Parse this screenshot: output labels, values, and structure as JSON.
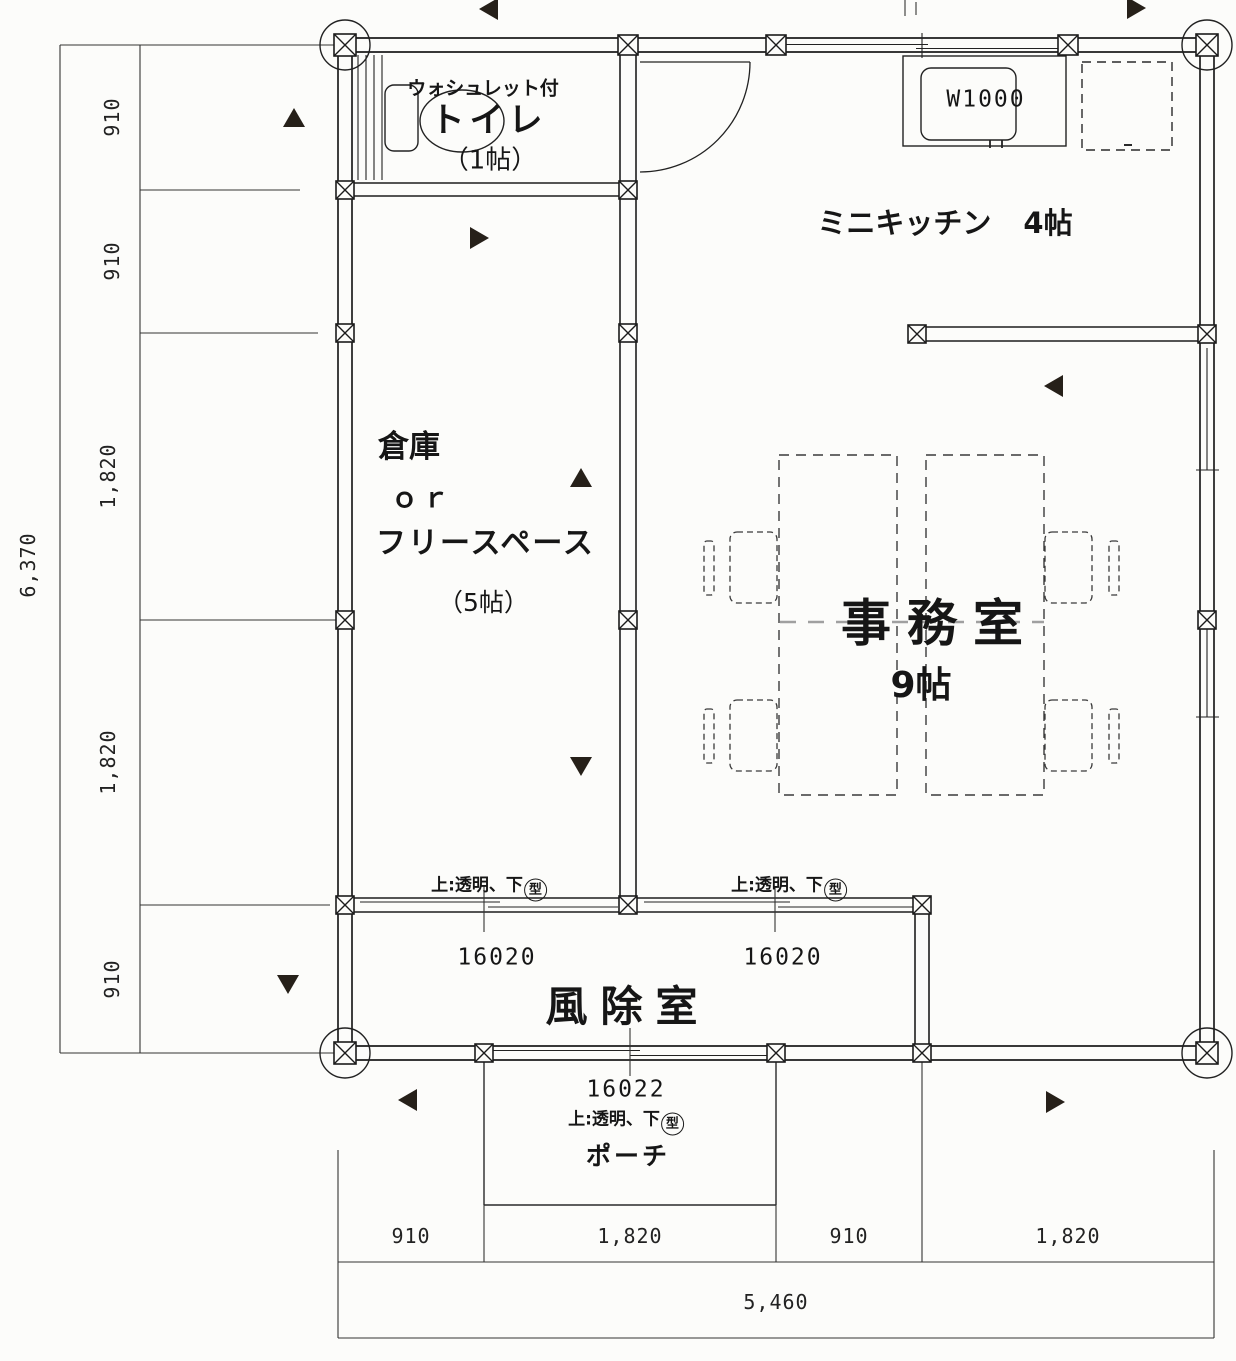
{
  "rooms": {
    "toilet": {
      "note": "ウォシュレット付",
      "name": "トイレ",
      "size": "（1帖）"
    },
    "kitchen": {
      "name": "ミニキッチン",
      "size": "4帖"
    },
    "storage": {
      "line1": "倉庫",
      "line2": "ｏｒ",
      "line3": "フリースペース",
      "size": "（5帖）"
    },
    "office": {
      "name": "事務室",
      "size": "9帖"
    },
    "vestibule": {
      "name": "風除室"
    },
    "porch": {
      "name": "ポーチ"
    }
  },
  "fixtures": {
    "kitchen_unit_width": "W1000"
  },
  "openings": {
    "window_a": {
      "code": "16020",
      "spec_prefix": "上:透明、下",
      "spec_circled": "型"
    },
    "window_b": {
      "code": "16020",
      "spec_prefix": "上:透明、下",
      "spec_circled": "型"
    },
    "entrance": {
      "code": "16022",
      "spec_prefix": "上:透明、下",
      "spec_circled": "型"
    }
  },
  "dimensions": {
    "left": [
      "910",
      "910",
      "1,820",
      "1,820",
      "910"
    ],
    "left_total": "6,370",
    "bottom": [
      "910",
      "1,820",
      "910",
      "1,820"
    ],
    "bottom_total": "5,460"
  },
  "colors": {
    "line": "#1d1d1d",
    "furniture_dash": "#3a3a3a",
    "grid_dash": "#a0a0a0",
    "marker": "#262019"
  }
}
